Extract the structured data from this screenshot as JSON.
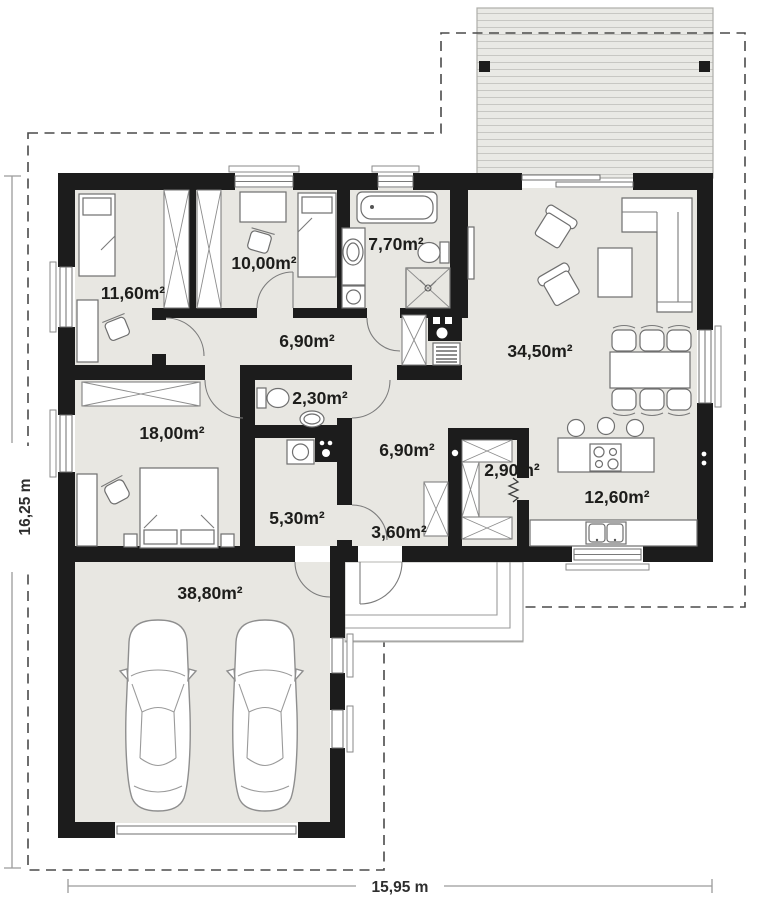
{
  "plan_title": "single-storey house floor plan with double garage and terrace",
  "rooms": [
    {
      "name": "bedroom-1",
      "area": "11,60m²"
    },
    {
      "name": "bedroom-2",
      "area": "10,00m²"
    },
    {
      "name": "bathroom",
      "area": "7,70m²"
    },
    {
      "name": "hall",
      "area": "6,90m²"
    },
    {
      "name": "living-room",
      "area": "34,50m²"
    },
    {
      "name": "wc",
      "area": "2,30m²"
    },
    {
      "name": "bedroom-3",
      "area": "18,00m²"
    },
    {
      "name": "corridor",
      "area": "6,90m²"
    },
    {
      "name": "pantry",
      "area": "2,90m²"
    },
    {
      "name": "kitchen",
      "area": "12,60m²"
    },
    {
      "name": "utility-room",
      "area": "5,30m²"
    },
    {
      "name": "entry-hall",
      "area": "3,60m²"
    },
    {
      "name": "garage",
      "area": "38,80m²"
    }
  ],
  "dimensions": {
    "height_label": "16,25 m",
    "width_label": "15,95 m"
  },
  "colors": {
    "wall": "#1c1c1c",
    "floor": "#e8e7e2",
    "terrace": "#e9e9e5",
    "terrace_stripe": "#c7c7c3",
    "boundary_dash": "#4a4a4a",
    "furniture_stroke": "#6f6f6f",
    "label_text": "#1d1d1b"
  }
}
